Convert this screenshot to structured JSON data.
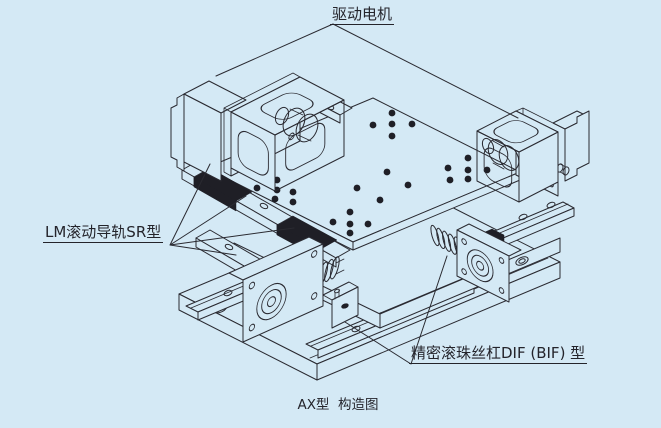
{
  "diagram": {
    "subject": "AX type cross-roller XY positioning stage, isometric construction drawing",
    "caption": "AX型  构造图"
  },
  "annotations": {
    "drive_motor": {
      "label": "驱动电机"
    },
    "lm_guide": {
      "label": "LM滚动导轨SR型"
    },
    "ball_screw": {
      "label": "精密滚珠丝杠DIF (BIF) 型"
    }
  },
  "colors": {
    "background": "#d4e9f5",
    "line": "#2a2a31",
    "dark_fill": "#1f1f26"
  }
}
